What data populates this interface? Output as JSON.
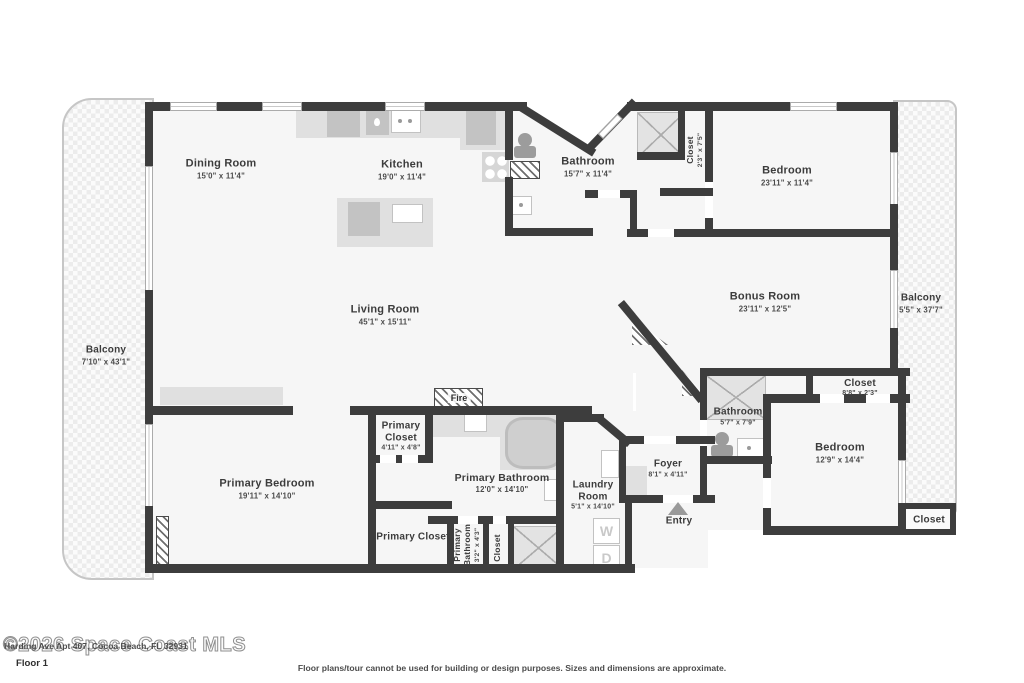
{
  "colors": {
    "wall": "#3d3d3d",
    "floor": "#f6f6f6",
    "fixture": "#e0e0e0",
    "balcony_border": "#c6c6c6",
    "label": "#3c3c3c"
  },
  "rooms": {
    "dining": {
      "name": "Dining Room",
      "dims": "15'0\" x 11'4\""
    },
    "kitchen": {
      "name": "Kitchen",
      "dims": "19'0\" x 11'4\""
    },
    "bathroom_top": {
      "name": "Bathroom",
      "dims": "15'7\" x 11'4\""
    },
    "closet_top": {
      "name": "Closet",
      "dims": "2'3\" x 7'5\""
    },
    "bedroom_top": {
      "name": "Bedroom",
      "dims": "23'11\" x 11'4\""
    },
    "bonus": {
      "name": "Bonus Room",
      "dims": "23'11\" x 12'5\""
    },
    "balcony_right": {
      "name": "Balcony",
      "dims": "5'5\" x 37'7\""
    },
    "balcony_left": {
      "name": "Balcony",
      "dims": "7'10\" x 43'1\""
    },
    "living": {
      "name": "Living Room",
      "dims": "45'1\" x 15'11\""
    },
    "closet_bonus": {
      "name": "Closet",
      "dims": "8'8\" x 2'3\""
    },
    "bathroom_right": {
      "name": "Bathroom",
      "dims": "5'7\" x 7'9\""
    },
    "bedroom_right": {
      "name": "Bedroom",
      "dims": "12'9\" x 14'4\""
    },
    "closet_br": {
      "name": "Closet"
    },
    "foyer": {
      "name": "Foyer",
      "dims": "8'1\" x 4'11\""
    },
    "entry": {
      "name": "Entry"
    },
    "laundry": {
      "name": "Laundry Room",
      "dims": "5'1\" x 14'10\""
    },
    "primary_bathroom": {
      "name": "Primary Bathroom",
      "dims": "12'0\" x 14'10\""
    },
    "primary_closet_top": {
      "name": "Primary Closet",
      "dims": "4'11\" x 4'8\""
    },
    "primary_closet_bottom": {
      "name": "Primary Closet"
    },
    "primary_bedroom": {
      "name": "Primary Bedroom",
      "dims": "19'11\" x 14'10\""
    },
    "primary_bathroom_small": {
      "name": "Primary Bathroom",
      "dims": "3'2\" x 4'3\""
    },
    "closet_small": {
      "name": "Closet"
    },
    "fire": {
      "name": "Fire"
    }
  },
  "appliances": {
    "washer": "W",
    "dryer": "D"
  },
  "footer": {
    "watermark": "©2026 Space Coast MLS",
    "address": "Harding Ave Apt 407, Cocoa Beach, FL 32931",
    "floor_label": "Floor 1",
    "disclaimer": "Floor plans/tour cannot be used for building or design purposes. Sizes and dimensions are approximate."
  }
}
